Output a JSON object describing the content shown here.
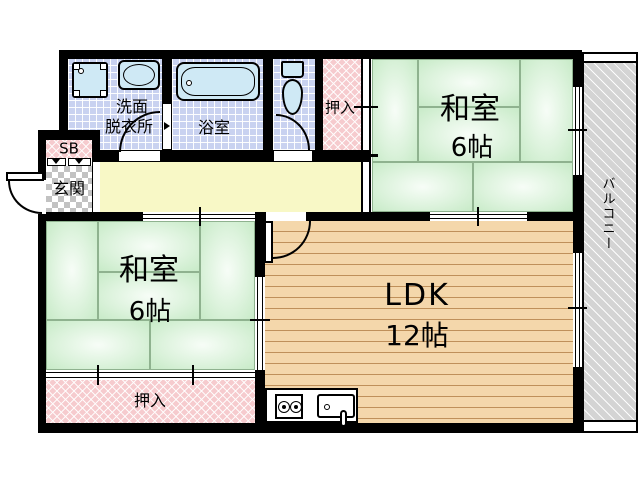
{
  "rooms": {
    "entrance": {
      "label": "玄関"
    },
    "shoe_box": {
      "label": "SB"
    },
    "washroom": {
      "line1": "洗面",
      "line2": "脱衣所"
    },
    "bathroom": {
      "label": "浴室"
    },
    "closet_north": {
      "label": "押入"
    },
    "tatami_northeast": {
      "name": "和室",
      "size": "6帖"
    },
    "tatami_southwest": {
      "name": "和室",
      "size": "6帖"
    },
    "ldk": {
      "name": "LDK",
      "size": "12帖"
    },
    "closet_south": {
      "label": "押入"
    },
    "balcony": {
      "label": "バルコニー"
    }
  },
  "colors": {
    "wall": "#000000",
    "tatami": "#c6eac6",
    "hallway": "#f8f8c6",
    "wood_floor": "#f4d7ab",
    "tile": "#c9d2f0",
    "closet_pink": "#f6cbce",
    "fixture_blue": "#cfe9f5",
    "balcony_gray": "#d4d4d4"
  }
}
